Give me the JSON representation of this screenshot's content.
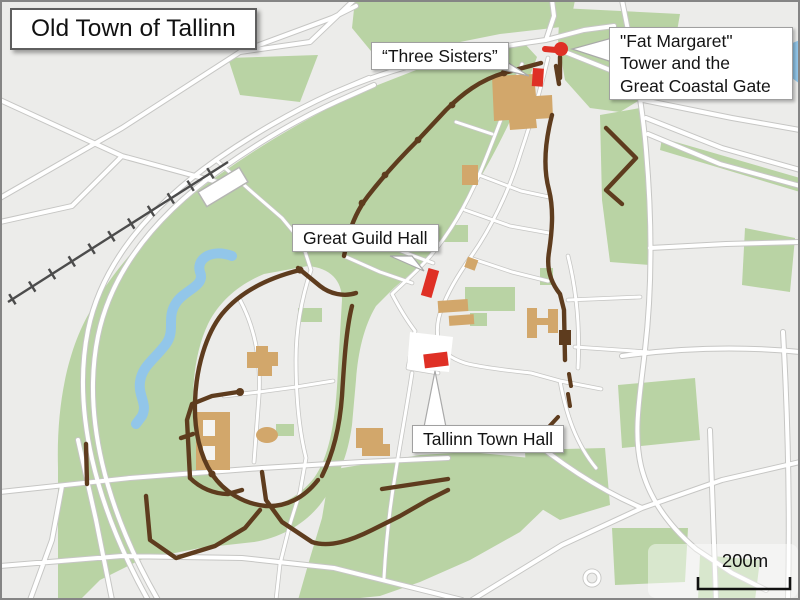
{
  "title": "Old Town of Tallinn",
  "labels": {
    "three_sisters": "“Three Sisters”",
    "fat_margaret": {
      "line1": "\"Fat Margaret\"",
      "line2": "Tower and the",
      "line3": "Great Coastal Gate"
    },
    "great_guild": "Great Guild Hall",
    "town_hall": "Tallinn Town Hall"
  },
  "scale_bar": {
    "label": "200m"
  },
  "landmarks": [
    "Three Sisters",
    "Fat Margaret Tower and the Great Coastal Gate",
    "Great Guild Hall",
    "Tallinn Town Hall"
  ],
  "colors": {
    "background": "#ececea",
    "park": "#b9d3a4",
    "brown": "#5e3c1e",
    "tan": "#d2a76b",
    "red": "#df3025",
    "water": "#92c6e9",
    "road": "#ffffff",
    "casing": "#c6c6c4",
    "rail": "#4c4c4c"
  }
}
